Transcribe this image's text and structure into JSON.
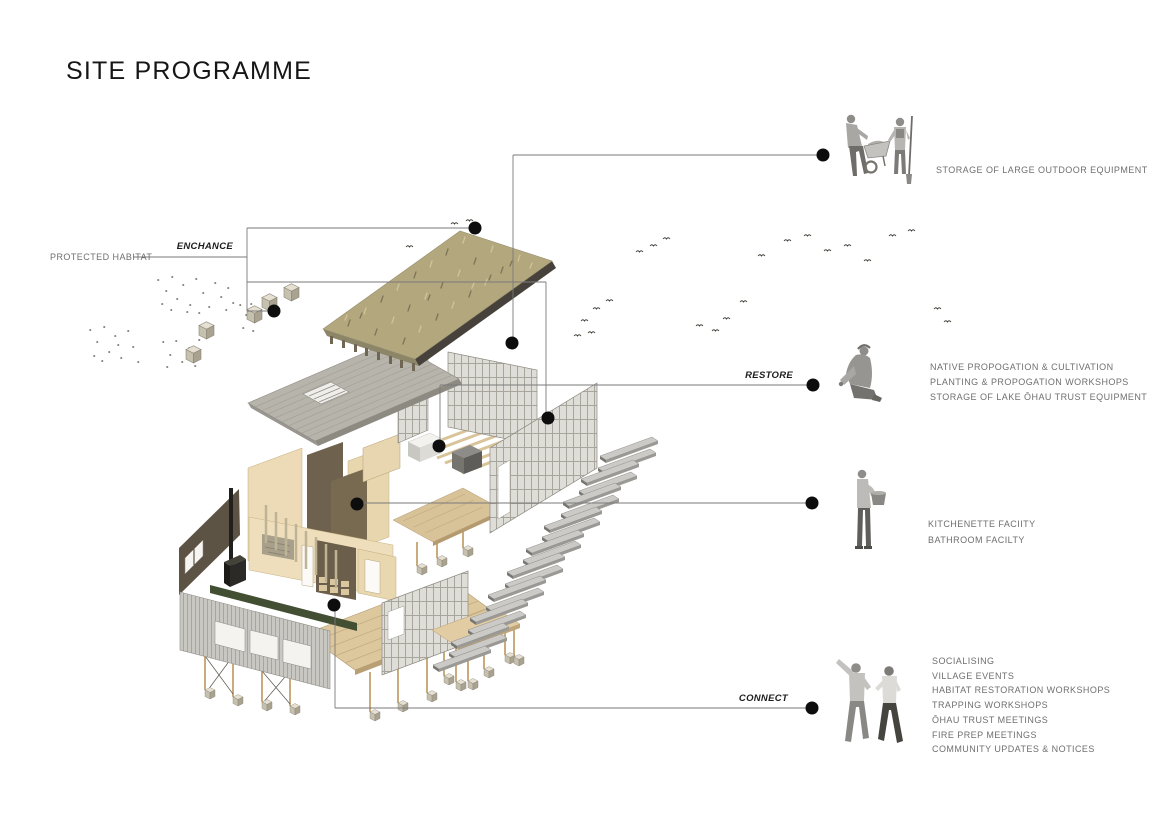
{
  "title": "SITE PROGRAMME",
  "left_labels": {
    "protected_habitat": "PROTECTED HABITAT",
    "enhance_verb": "ENCHANCE"
  },
  "callouts": {
    "storage": {
      "items": [
        "STORAGE OF LARGE OUTDOOR EQUIPMENT"
      ],
      "figure": "two-gardeners-with-wheelbarrow-and-shovel"
    },
    "restore": {
      "verb": "RESTORE",
      "items": [
        "NATIVE PROPOGATION & CULTIVATION",
        "PLANTING & PROPOGATION WORKSHOPS",
        "STORAGE OF LAKE ŌHAU TRUST EQUIPMENT"
      ],
      "figure": "kneeling-planter"
    },
    "facilities": {
      "items": [
        "KITCHENETTE FACIITY",
        "BATHROOM FACILTY"
      ],
      "figure": "person-holding-pot"
    },
    "connect": {
      "verb": "CONNECT",
      "items": [
        "SOCIALISING",
        "VILLAGE EVENTS",
        "HABITAT RESTORATION WORKSHOPS",
        "TRAPPING WORKSHOPS",
        "ŌHAU TRUST MEETINGS",
        "FIRE PREP MEETINGS",
        "COMMUNITY UPDATES & NOTICES"
      ],
      "figure": "two-people-talking"
    }
  },
  "colors": {
    "background": "#ffffff",
    "callout_line": "#7a7a7a",
    "dot": "#0d0d0d",
    "label_text": "#6f6f6f",
    "verb_text": "#1d1d1d",
    "grass_roof": "#b3a77e",
    "gray_canopy": "#b7b4ac",
    "lattice": "#deddd7",
    "wall_tan": "#ecdbb6",
    "wall_dark_brown": "#5d5345",
    "deck_wood": "#ddc79d",
    "green_beam": "#434f33",
    "figure_gray": "#9a9896"
  }
}
